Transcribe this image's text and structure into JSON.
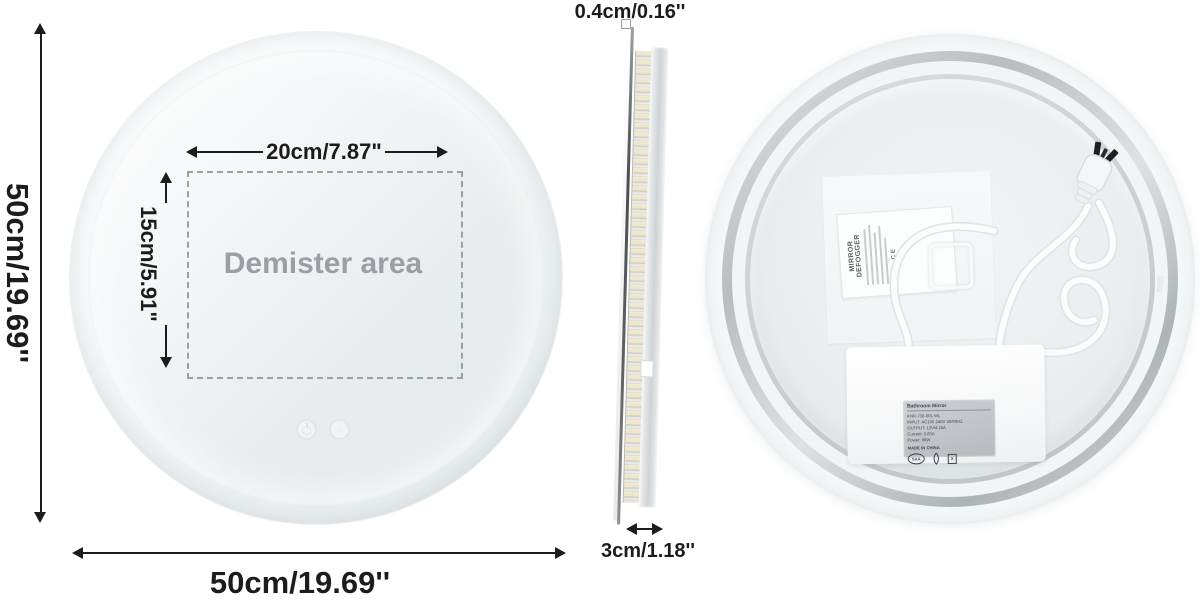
{
  "front_view": {
    "diameter_label_left": "50cm/19.69''",
    "diameter_label_bottom": "50cm/19.69''",
    "demister_width_label": "20cm/7.87\"",
    "demister_height_label": "15cm/5.91\"",
    "demister_area_label": "Demister area"
  },
  "side_view": {
    "thickness_label": "0.4cm/0.16''",
    "frame_depth_label": "3cm/1.18''"
  },
  "back_view": {
    "defogger_label": {
      "title": "MIRROR DEFOGGER",
      "certs": "CE"
    },
    "driver_label": {
      "title": "Bathroom Mirror",
      "lines": [
        "KNR-738-601-WL",
        "INPUT: AC100-240V 50/60HZ",
        "OUTPUT: 12V/4.16A",
        "Current: 0.83A",
        "Power: 96W"
      ],
      "made_in": "MADE IN CHINA",
      "cert_saa": "SAA",
      "cert_bin": "x"
    }
  },
  "colors": {
    "dimension": "#1c1c1c",
    "demister_text": "#9b9fa3",
    "silver": "#c3c7c9",
    "led_warm": "#f2ead0"
  }
}
